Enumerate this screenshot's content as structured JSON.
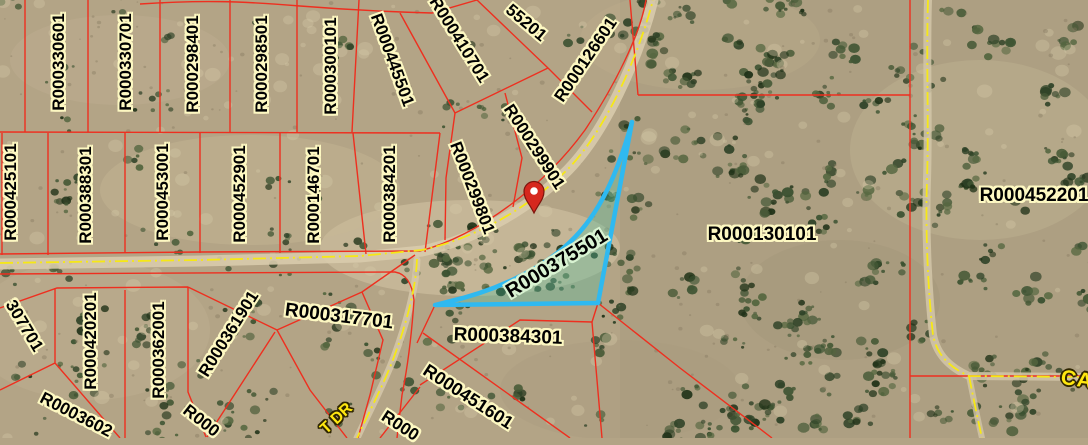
{
  "map": {
    "highlighted_parcel": "R000375501",
    "colors": {
      "parcel_line": "#ee2f1f",
      "road_centerline": "#f6e815",
      "highlight_stroke": "#2fb9f0",
      "highlight_fill": "rgba(75,190,160,0.33)",
      "label_halo": "#fdf8c2",
      "selected_label_halo": "#d9f3d2",
      "road_label_color": "#ffe70f",
      "marker_color": "#d6281e"
    },
    "marker": "location-pin",
    "parcels": {
      "r000330601": "R000330601",
      "r000330701": "R000330701",
      "r000298401": "R000298401",
      "r000298501": "R000298501",
      "r000300101": "R000300101",
      "r000445501": "R000445501",
      "r000410701": "R000410701",
      "r000355201_partial": "55201",
      "r000126601": "R000126601",
      "r000425101": "R000425101",
      "r000388301": "R000388301",
      "r000453001": "R000453001",
      "r000452901": "R000452901",
      "r000146701": "R000146701",
      "r000384201": "R000384201",
      "r000299801": "R000299801",
      "r000299901": "R000299901",
      "r000375501": "R000375501",
      "r000130101": "R000130101",
      "r000452201": "R000452201",
      "r000317701": "R000317701",
      "r000384301": "R000384301",
      "r000451601": "R000451601",
      "r000307701_partial": "307701",
      "r000420201": "R000420201",
      "r000362001": "R000362001",
      "r000361901": "R000361901",
      "r0003602_partial": "R0003602",
      "r000_partial_a": "R000",
      "r000_partial_b": "R000"
    },
    "road_labels": {
      "partial_1": "T DR",
      "partial_2": "CA"
    }
  }
}
